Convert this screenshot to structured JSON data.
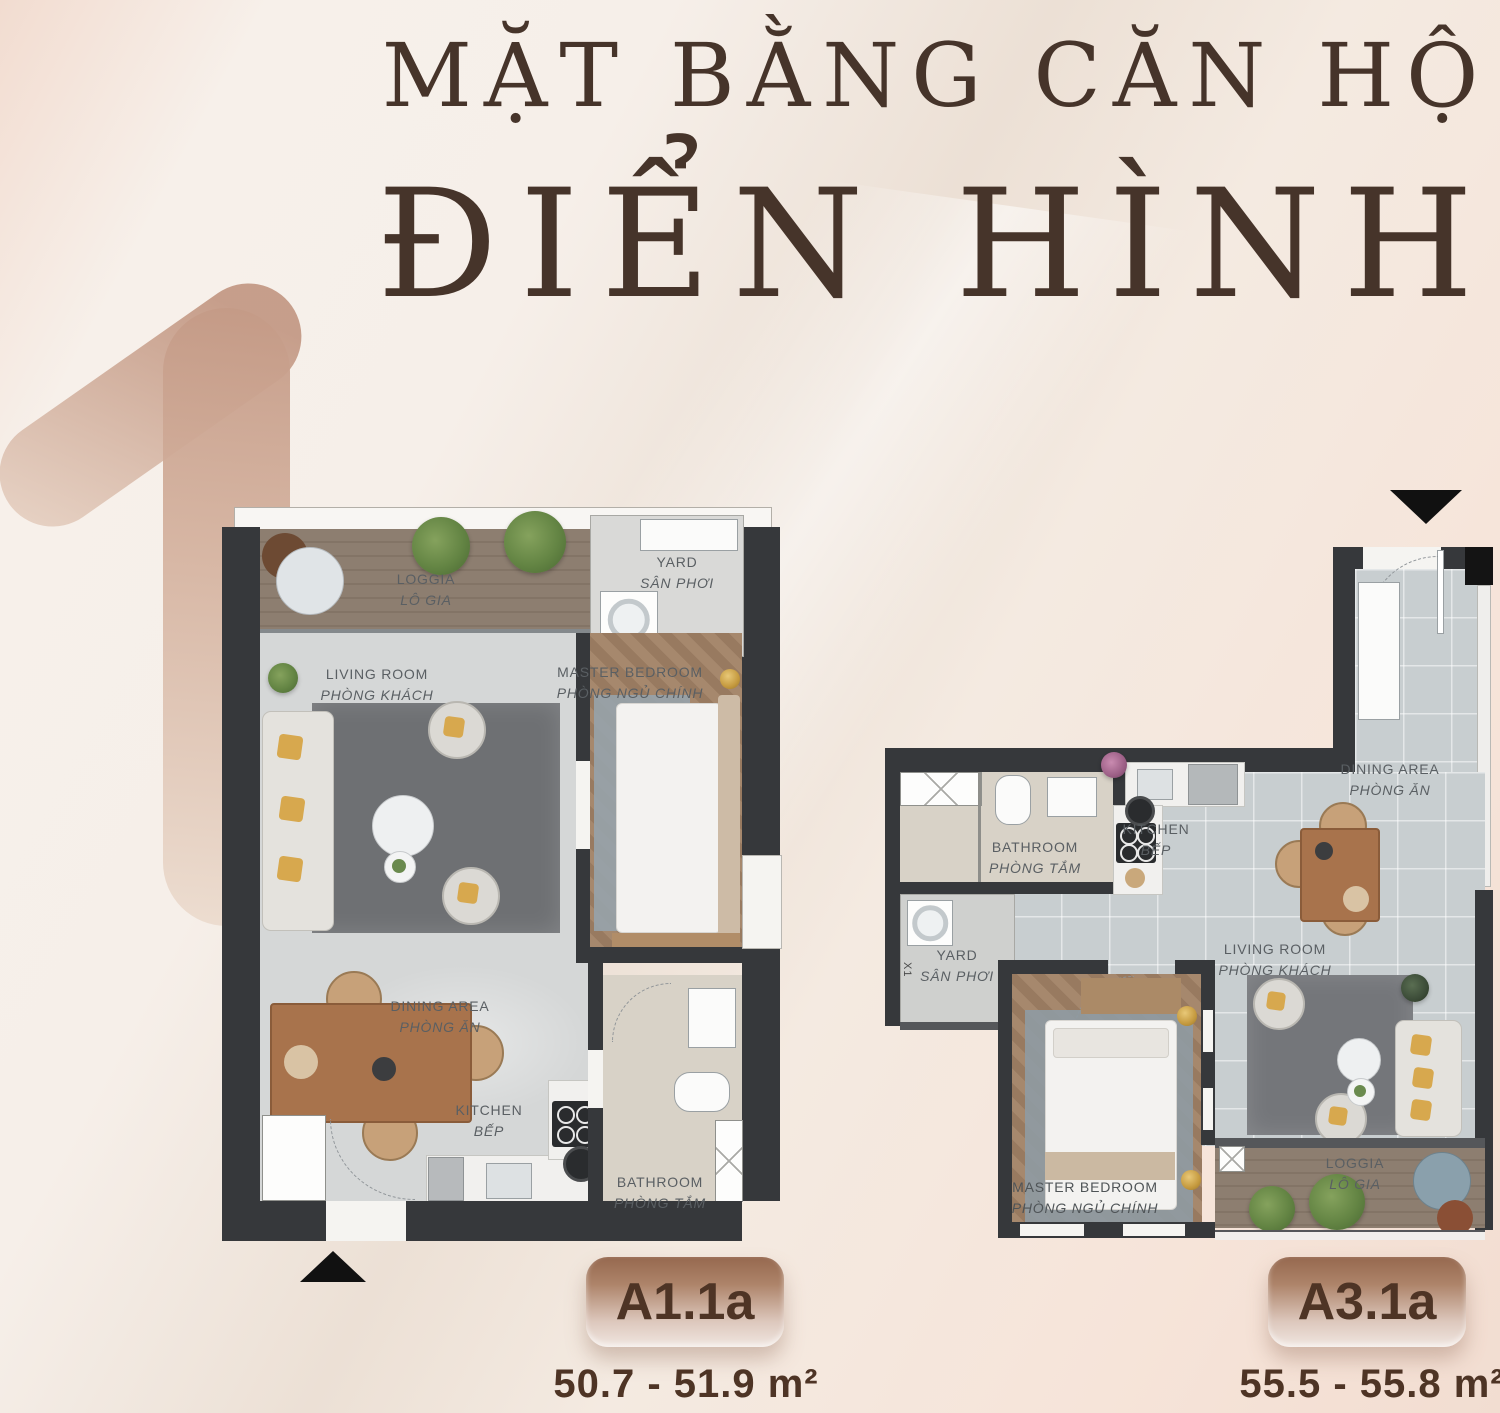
{
  "title": {
    "line1": "MẶT BẰNG CĂN HỘ",
    "line2": "ĐIỂN HÌNH"
  },
  "watermark_number": "1",
  "colors": {
    "title_text": "#46342a",
    "badge_text": "#4e3425",
    "badge_gradient_top": "#96684f",
    "badge_gradient_bottom": "#f0e6e0",
    "room_label": "#5a5f63",
    "wall": "#36383b",
    "background": "#f3ebe3"
  },
  "plans": [
    {
      "badge": "A1.1a",
      "area_range": "50.7 - 51.9 m²",
      "entry_marker": "up",
      "rooms": [
        {
          "en": "LOGGIA",
          "vi": "LÔ GIA"
        },
        {
          "en": "YARD",
          "vi": "SÂN PHƠI"
        },
        {
          "en": "LIVING ROOM",
          "vi": "PHÒNG KHÁCH"
        },
        {
          "en": "MASTER BEDROOM",
          "vi": "PHÒNG NGỦ CHÍNH"
        },
        {
          "en": "DINING AREA",
          "vi": "PHÒNG ĂN"
        },
        {
          "en": "KITCHEN",
          "vi": "BẾP"
        },
        {
          "en": "BATHROOM",
          "vi": "PHÒNG TẮM"
        }
      ]
    },
    {
      "badge": "A3.1a",
      "area_range": "55.5 - 55.8 m²",
      "entry_marker": "down",
      "shaft_label": "X1",
      "rooms": [
        {
          "en": "BATHROOM",
          "vi": "PHÒNG TẮM"
        },
        {
          "en": "KITCHEN",
          "vi": "BẾP"
        },
        {
          "en": "DINING AREA",
          "vi": "PHÒNG ĂN"
        },
        {
          "en": "YARD",
          "vi": "SÂN PHƠI"
        },
        {
          "en": "LIVING ROOM",
          "vi": "PHÒNG KHÁCH"
        },
        {
          "en": "MASTER BEDROOM",
          "vi": "PHÒNG NGỦ CHÍNH"
        },
        {
          "en": "LOGGIA",
          "vi": "LÔ GIA"
        }
      ]
    }
  ]
}
